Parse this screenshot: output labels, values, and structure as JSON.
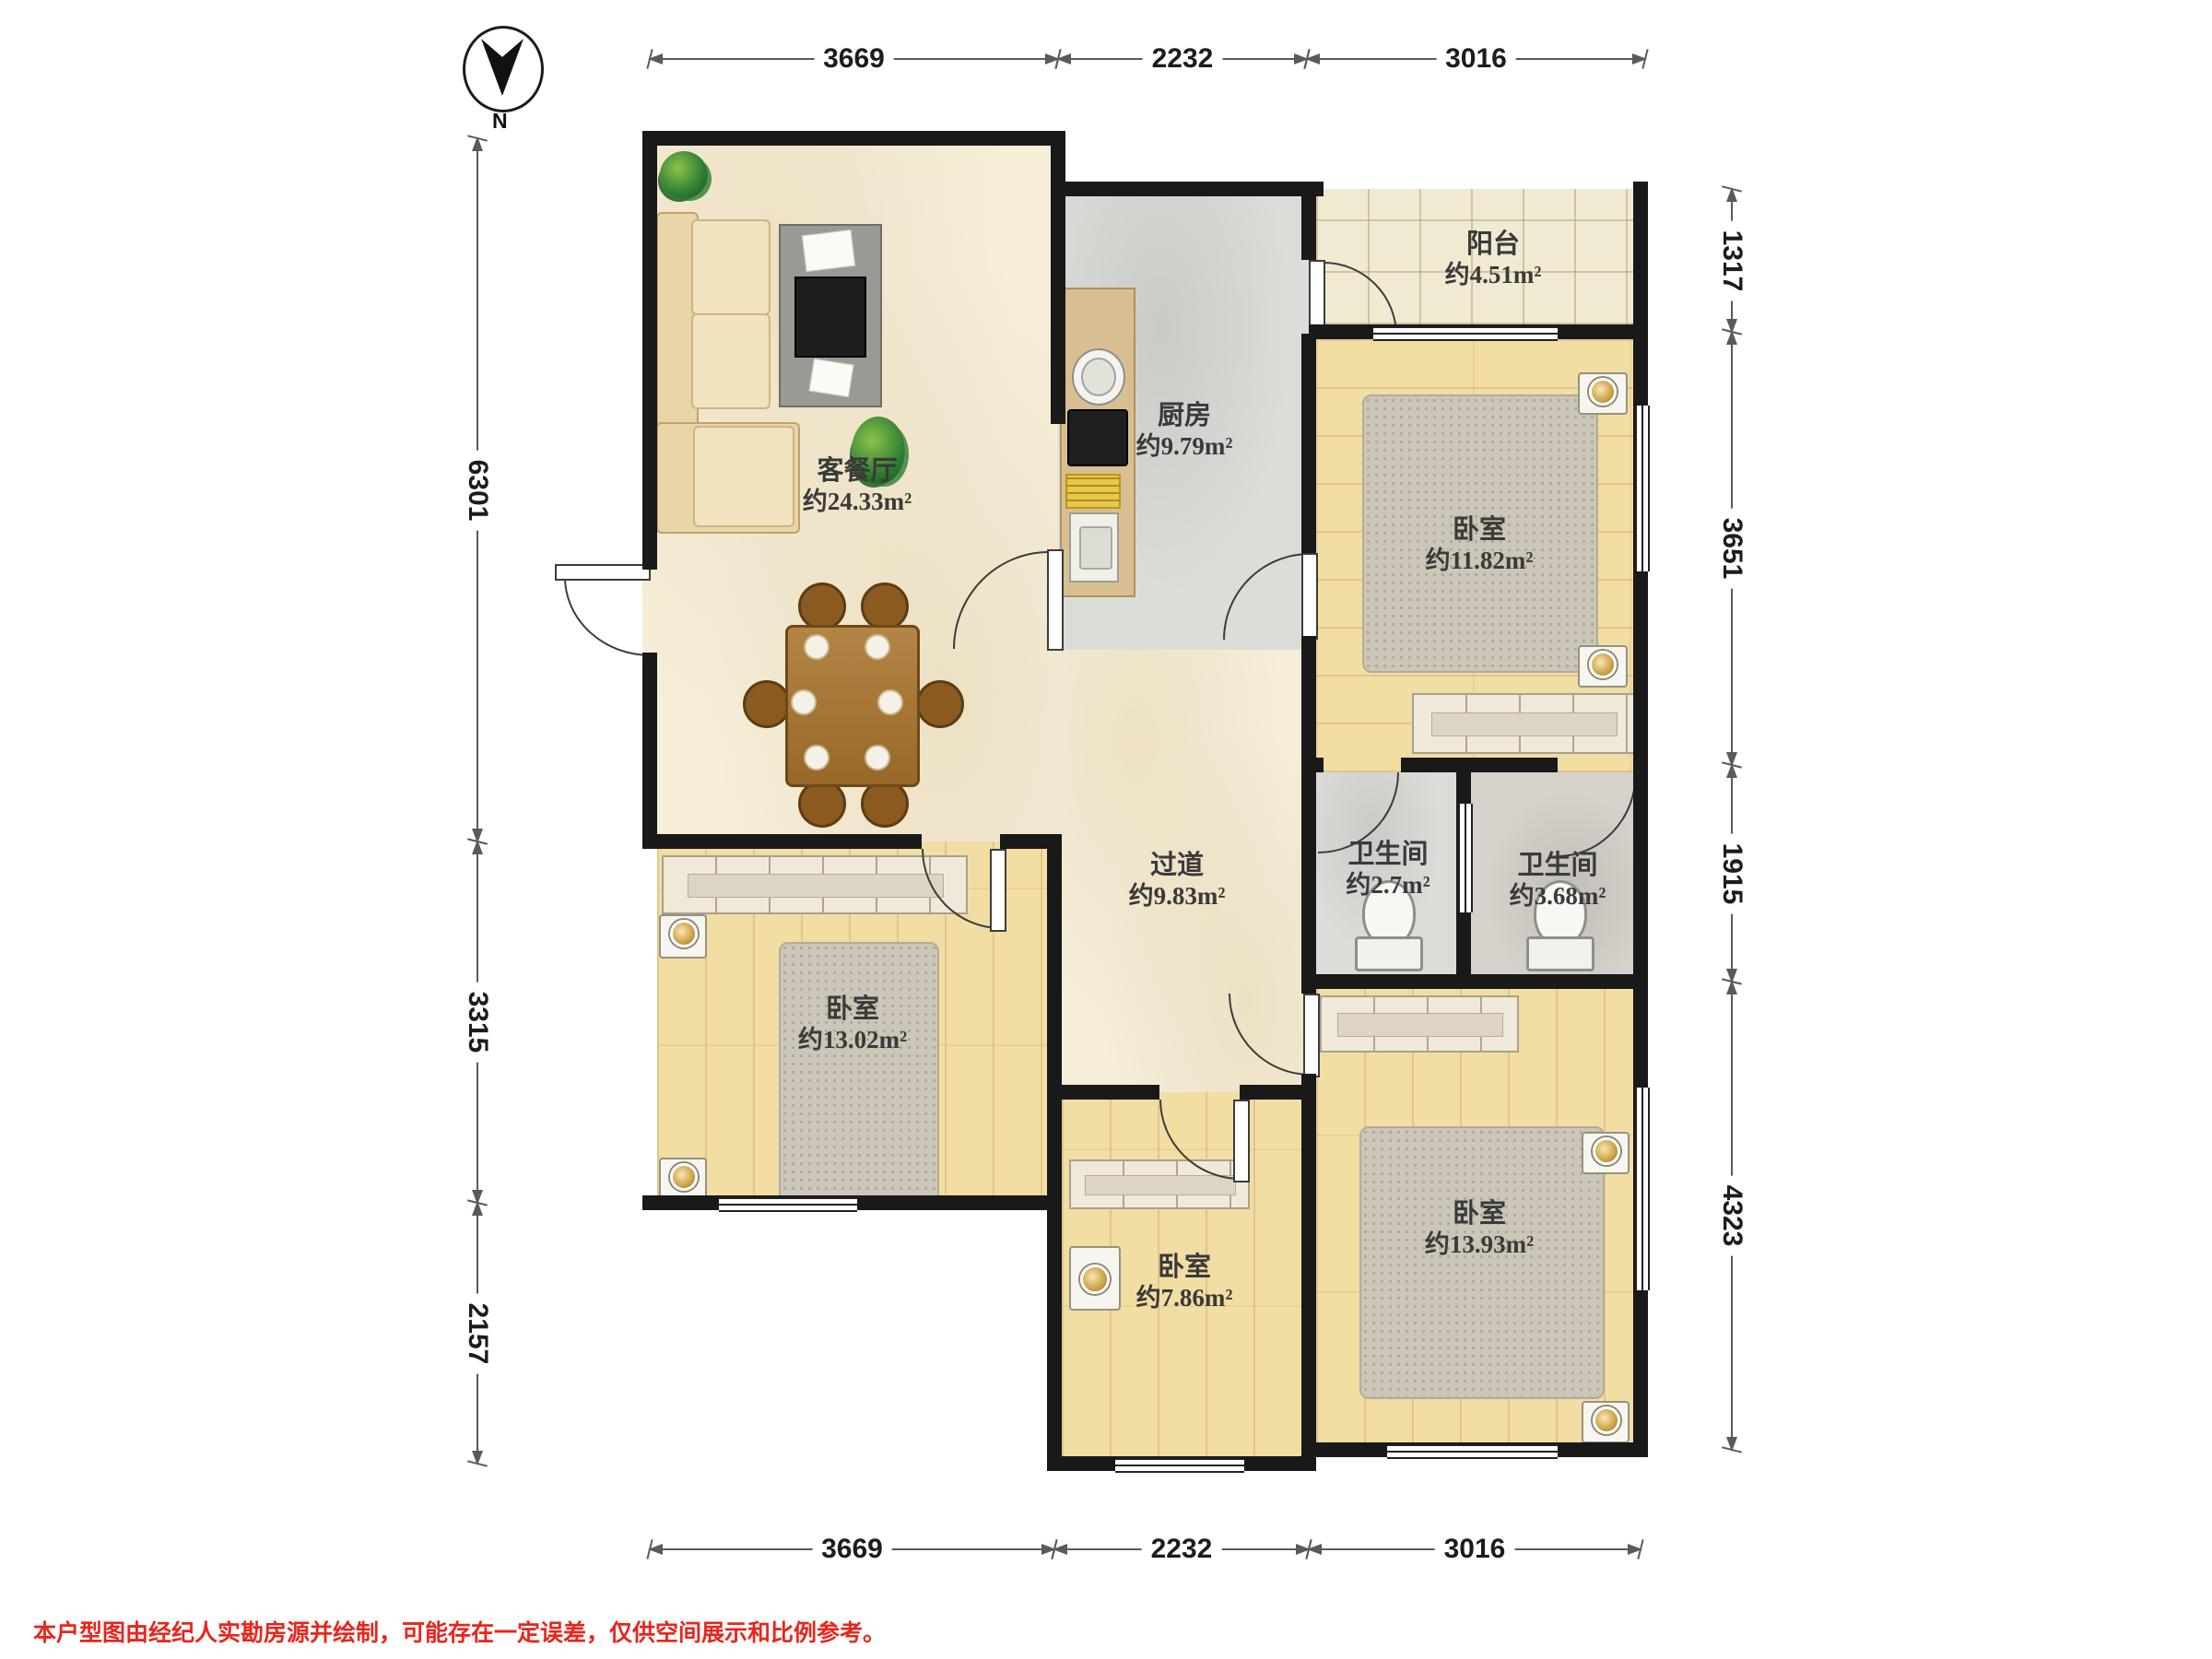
{
  "compass": {
    "north_label": "N"
  },
  "disclaimer": "本户型图由经纪人实勘房源并绘制，可能存在一定误差，仅供空间展示和比例参考。",
  "dimensions": {
    "top": [
      "3669",
      "2232",
      "3016"
    ],
    "bottom": [
      "3669",
      "2232",
      "3016"
    ],
    "left": [
      "6301",
      "3315",
      "2157"
    ],
    "right": [
      "1317",
      "3651",
      "1915",
      "4323"
    ]
  },
  "rooms": [
    {
      "name": "客餐厅",
      "area": "约24.33m²"
    },
    {
      "name": "厨房",
      "area": "约9.79m²"
    },
    {
      "name": "阳台",
      "area": "约4.51m²"
    },
    {
      "name": "卧室",
      "area": "约11.82m²"
    },
    {
      "name": "过道",
      "area": "约9.83m²"
    },
    {
      "name": "卫生间",
      "area": "约2.7m²"
    },
    {
      "name": "卫生间",
      "area": "约3.68m²"
    },
    {
      "name": "卧室",
      "area": "约13.02m²"
    },
    {
      "name": "卧室",
      "area": "约7.86m²"
    },
    {
      "name": "卧室",
      "area": "约13.93m²"
    }
  ],
  "colors": {
    "wall": "#191919",
    "marble_floor": "#f6eed9",
    "wood_floor": "#f2dda3",
    "gray_floor": "#dcdcd9",
    "tile_floor": "#f1ead2",
    "blanket": "#6d4b28",
    "disclaimer_red": "#e8261c"
  }
}
